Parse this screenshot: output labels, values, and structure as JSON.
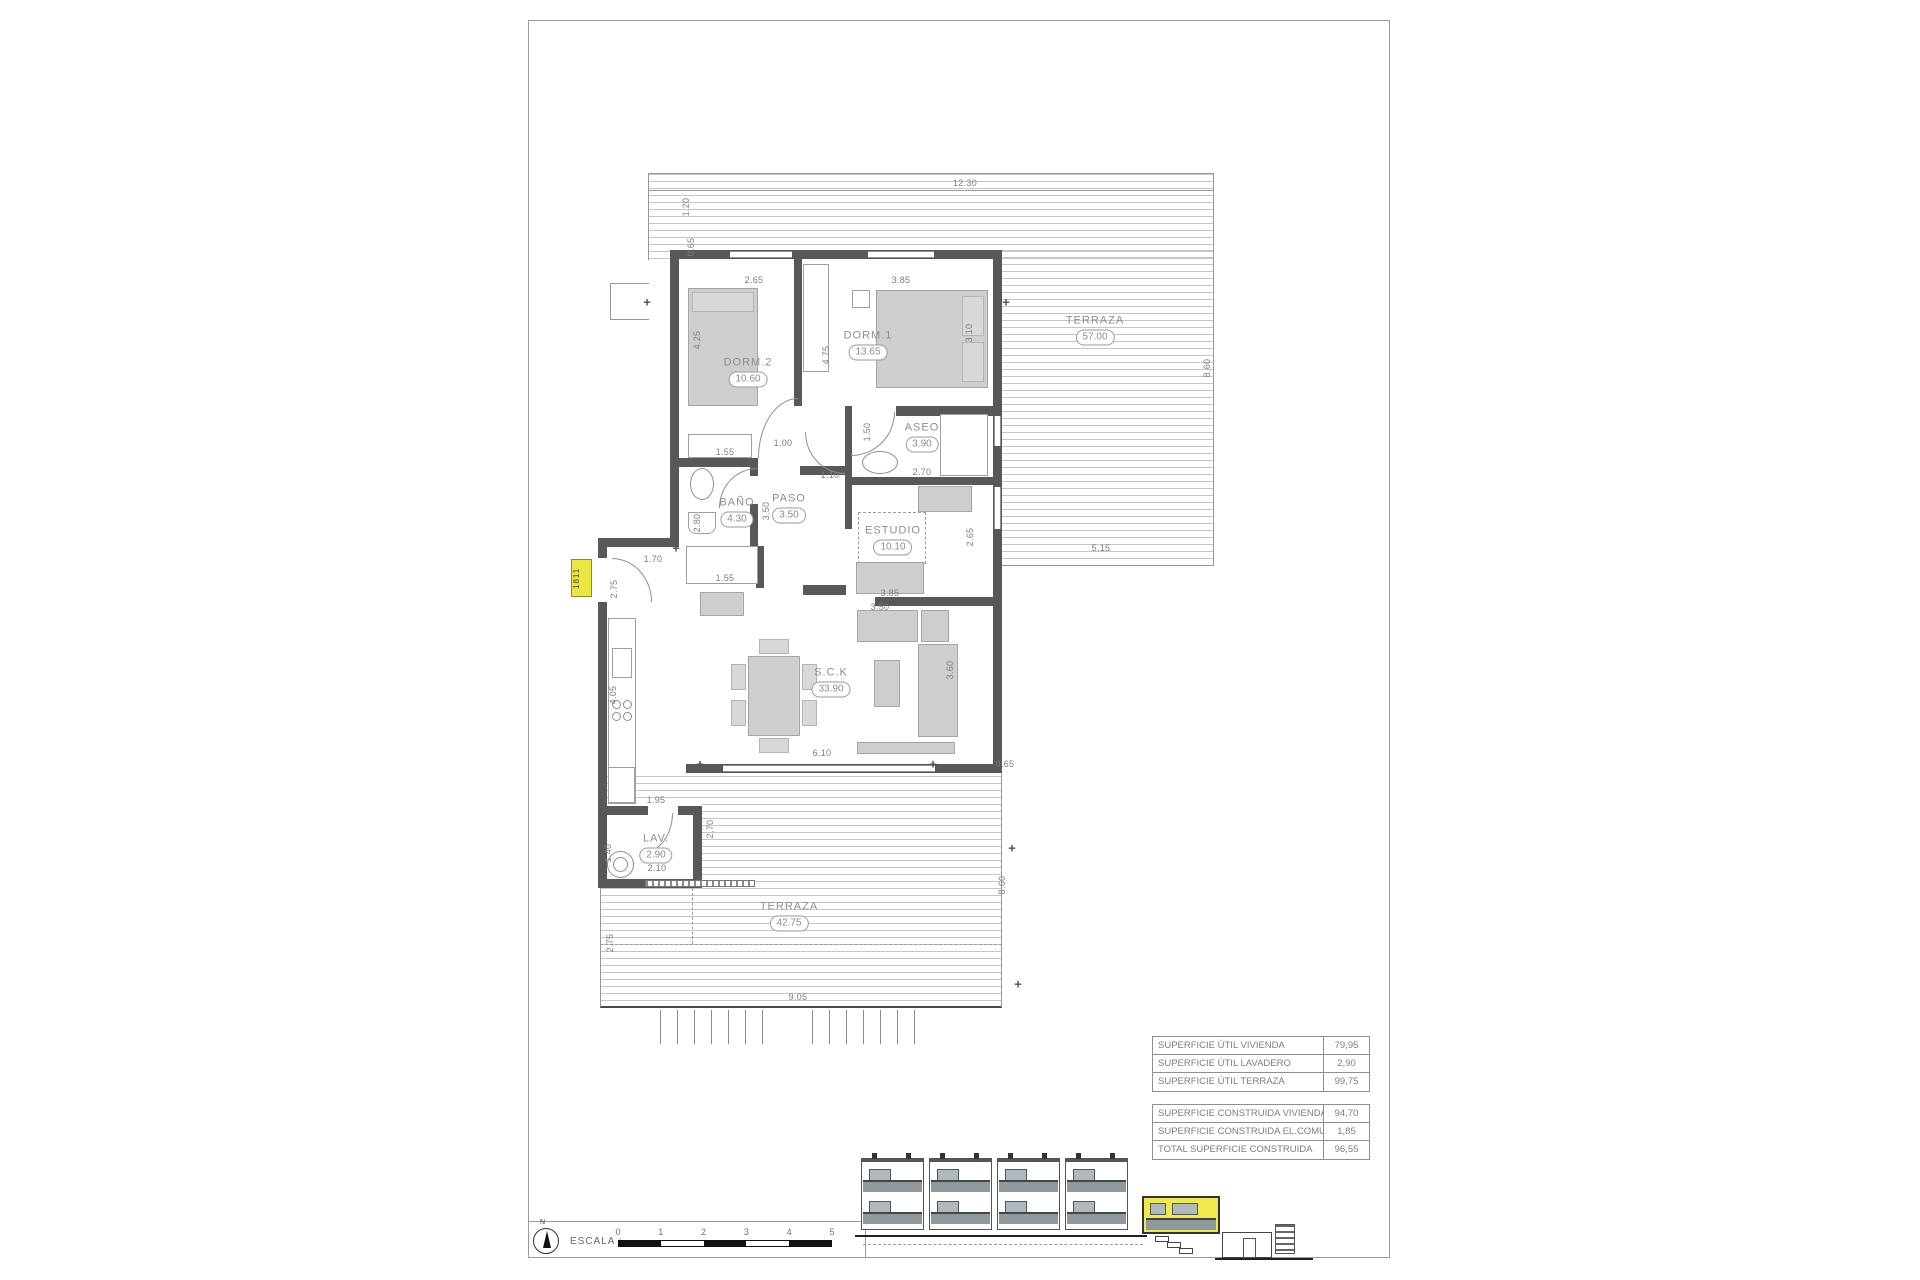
{
  "sheet": {
    "unit_tag": "1811",
    "north_label": "N",
    "scale": {
      "label": "ESCALA :",
      "ticks": [
        "0",
        "1",
        "2",
        "3",
        "4",
        "5"
      ]
    }
  },
  "plan": {
    "rooms": [
      {
        "name": "DORM.2",
        "area": "10.60",
        "x": 748,
        "y": 372
      },
      {
        "name": "DORM.1",
        "area": "13.65",
        "x": 868,
        "y": 345
      },
      {
        "name": "ASEO",
        "area": "3.90",
        "x": 922,
        "y": 437
      },
      {
        "name": "BAÑO",
        "area": "4.30",
        "x": 737,
        "y": 512
      },
      {
        "name": "PASO",
        "area": "3.50",
        "x": 789,
        "y": 508
      },
      {
        "name": "ESTUDIO",
        "area": "10.10",
        "x": 893,
        "y": 540
      },
      {
        "name": "S.C.K",
        "area": "33.90",
        "x": 831,
        "y": 682
      },
      {
        "name": "LAV.",
        "area": "2.90",
        "x": 656,
        "y": 848
      },
      {
        "name": "TERRAZA",
        "area": "57.00",
        "x": 1095,
        "y": 330
      },
      {
        "name": "TERRAZA",
        "area": "42.75",
        "x": 789,
        "y": 916
      }
    ],
    "dimensions": [
      {
        "t": "12.30",
        "x": 965,
        "y": 183,
        "rot": false
      },
      {
        "t": "1.20",
        "x": 686,
        "y": 207,
        "rot": true
      },
      {
        "t": "0.65",
        "x": 691,
        "y": 247,
        "rot": true
      },
      {
        "t": "2.65",
        "x": 754,
        "y": 280,
        "rot": false
      },
      {
        "t": "3.85",
        "x": 901,
        "y": 280,
        "rot": false
      },
      {
        "t": "3.10",
        "x": 969,
        "y": 333,
        "rot": true
      },
      {
        "t": "8.60",
        "x": 1207,
        "y": 368,
        "rot": true
      },
      {
        "t": "4.25",
        "x": 697,
        "y": 340,
        "rot": true
      },
      {
        "t": "4.75",
        "x": 826,
        "y": 355,
        "rot": true
      },
      {
        "t": "1.50",
        "x": 867,
        "y": 432,
        "rot": true
      },
      {
        "t": "2.70",
        "x": 922,
        "y": 472,
        "rot": false
      },
      {
        "t": "1.55",
        "x": 725,
        "y": 452,
        "rot": false
      },
      {
        "t": "1.00",
        "x": 783,
        "y": 443,
        "rot": false
      },
      {
        "t": "1.10",
        "x": 830,
        "y": 475,
        "rot": false
      },
      {
        "t": "3.50",
        "x": 766,
        "y": 511,
        "rot": true
      },
      {
        "t": "2.80",
        "x": 697,
        "y": 523,
        "rot": true
      },
      {
        "t": "1.55",
        "x": 725,
        "y": 578,
        "rot": false
      },
      {
        "t": "1.70",
        "x": 653,
        "y": 559,
        "rot": false
      },
      {
        "t": "2.75",
        "x": 614,
        "y": 589,
        "rot": true
      },
      {
        "t": "2.65",
        "x": 970,
        "y": 537,
        "rot": true
      },
      {
        "t": "3.85",
        "x": 890,
        "y": 593,
        "rot": false
      },
      {
        "t": "5.15",
        "x": 1101,
        "y": 548,
        "rot": false
      },
      {
        "t": "3.50",
        "x": 880,
        "y": 607,
        "rot": false
      },
      {
        "t": "3.60",
        "x": 950,
        "y": 670,
        "rot": true
      },
      {
        "t": "4.05",
        "x": 613,
        "y": 695,
        "rot": true
      },
      {
        "t": "6.10",
        "x": 822,
        "y": 753,
        "rot": false
      },
      {
        "t": "0.65",
        "x": 1005,
        "y": 764,
        "rot": false
      },
      {
        "t": "1.95",
        "x": 656,
        "y": 800,
        "rot": false
      },
      {
        "t": "2.70",
        "x": 710,
        "y": 829,
        "rot": true
      },
      {
        "t": "1.40",
        "x": 608,
        "y": 853,
        "rot": true
      },
      {
        "t": "2.10",
        "x": 657,
        "y": 868,
        "rot": false
      },
      {
        "t": "2.75",
        "x": 610,
        "y": 943,
        "rot": true
      },
      {
        "t": "8.60",
        "x": 1002,
        "y": 885,
        "rot": true
      },
      {
        "t": "9.05",
        "x": 798,
        "y": 997,
        "rot": false
      }
    ]
  },
  "area_tables": {
    "useful": {
      "rows": [
        [
          "SUPERFICIE ÚTIL VIVIENDA",
          "79,95"
        ],
        [
          "SUPERFICIE ÚTIL LAVADERO",
          "2,90"
        ],
        [
          "SUPERFICIE ÚTIL TERRAZA",
          "99,75"
        ]
      ]
    },
    "built": {
      "rows": [
        [
          "SUPERFICIE CONSTRUIDA VIVIENDA",
          "94,70"
        ],
        [
          "SUPERFICIE CONSTRUIDA EL.COMUNES",
          "1,85"
        ],
        [
          "TOTAL SUPERFICIE CONSTRUIDA",
          "96,55"
        ]
      ]
    }
  }
}
